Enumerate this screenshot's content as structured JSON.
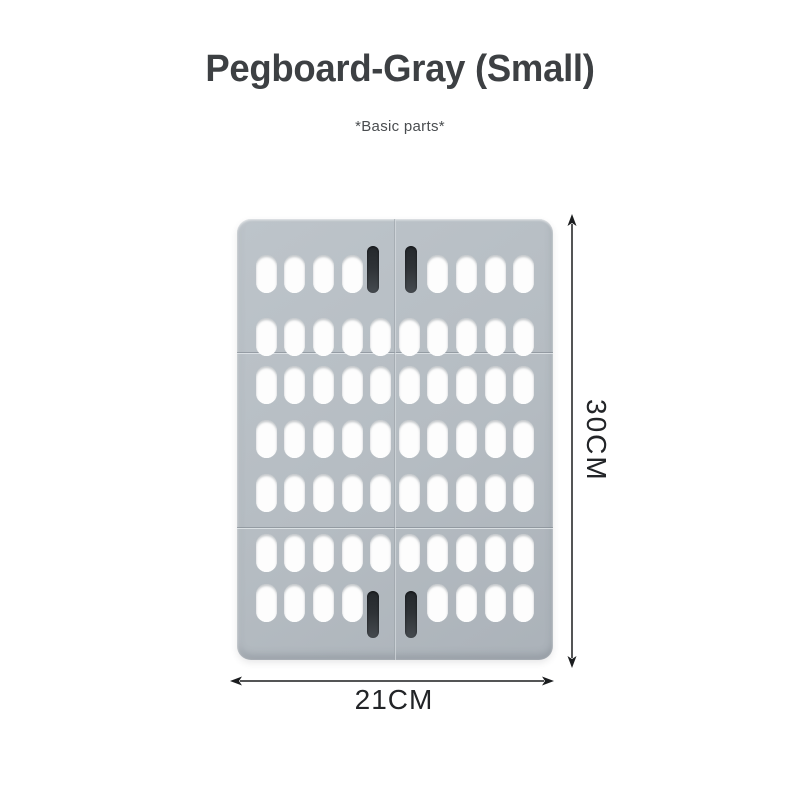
{
  "page": {
    "background": "#ffffff"
  },
  "header": {
    "title": "Pegboard-Gray (Small)",
    "subtitle": "*Basic parts*"
  },
  "product": {
    "name": "Pegboard",
    "color_name": "Gray",
    "size_name": "Small",
    "board_color": "#b5bcc2",
    "hole_color": "#fdfdfd",
    "hook_slot_color": "#2b3034",
    "board": {
      "columns": 10,
      "hole_rows": 7,
      "sections": [
        {
          "name": "top-panel",
          "rows": [
            1,
            2
          ]
        },
        {
          "name": "middle-panel",
          "rows": [
            3,
            4,
            5
          ]
        },
        {
          "name": "bottom-panel",
          "rows": [
            6,
            7
          ]
        }
      ],
      "hook_slots": [
        {
          "row": 1,
          "columns": [
            5,
            6
          ],
          "extends": "up"
        },
        {
          "row": 7,
          "columns": [
            5,
            6
          ],
          "extends": "down"
        }
      ]
    }
  },
  "dimensions": {
    "height_label": "30CM",
    "width_label": "21CM"
  }
}
